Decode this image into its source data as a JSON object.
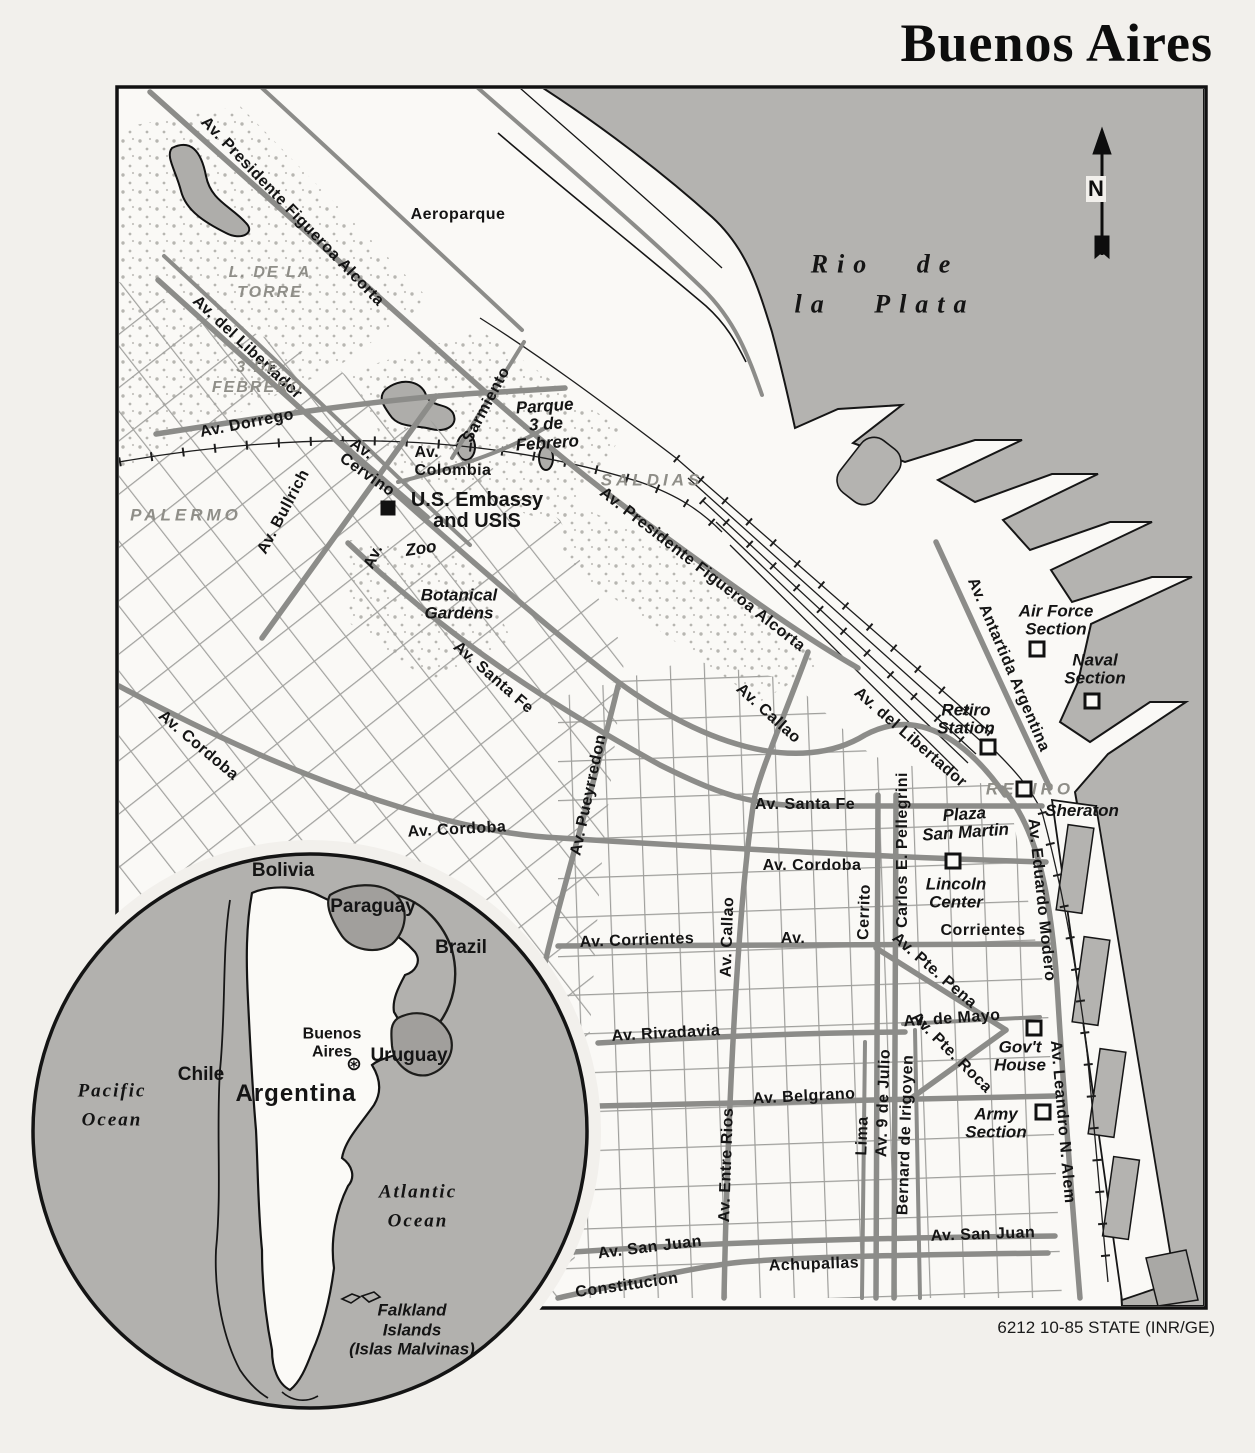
{
  "title": "Buenos Aires",
  "credit": "6212 10-85 STATE (INR/GE)",
  "north_label": "N",
  "colors": {
    "paper": "#f2f0ec",
    "land": "#faf9f6",
    "river": "#b4b3b0",
    "road": "#8c8c89",
    "grid": "#9f9f9c",
    "lake": "#aeadaa",
    "gray_text": "#8f8e88",
    "ink": "#141414"
  },
  "labels": [
    {
      "name": "av-presidente-figueroa-alcorta-1",
      "text": "Av. Presidente Figueroa Alcorta",
      "cls": "road",
      "x": 292,
      "y": 212,
      "rot": 46
    },
    {
      "name": "aeroparque",
      "text": "Aeroparque",
      "cls": "road",
      "x": 458,
      "y": 215,
      "rot": 0
    },
    {
      "name": "rio-de-la-plata",
      "text": "Rio de\nla Plata",
      "cls": "water",
      "x": 885,
      "y": 285,
      "rot": 0
    },
    {
      "name": "l-de-la-torre",
      "text": "L. DE LA\nTORRE",
      "cls": "gray-sm",
      "x": 270,
      "y": 283,
      "rot": 0
    },
    {
      "name": "av-del-libertador-1",
      "text": "Av. del Libertador",
      "cls": "road",
      "x": 247,
      "y": 348,
      "rot": 43
    },
    {
      "name": "3-de-febrero",
      "text": "3 DE\nFEBRERO",
      "cls": "gray-sm",
      "x": 258,
      "y": 378,
      "rot": 0
    },
    {
      "name": "av-dorrego",
      "text": "Av. Dorrego",
      "cls": "road",
      "x": 247,
      "y": 424,
      "rot": -11
    },
    {
      "name": "sarmiento",
      "text": "Sarmiento",
      "cls": "road",
      "x": 487,
      "y": 405,
      "rot": -62
    },
    {
      "name": "parque-3-de-febrero",
      "text": "Parque\n3 de\nFebrero",
      "cls": "place",
      "x": 546,
      "y": 425,
      "rot": -4
    },
    {
      "name": "av-cervino",
      "text": "Av.\nCervino",
      "cls": "road",
      "x": 372,
      "y": 468,
      "rot": 35
    },
    {
      "name": "av-colombia",
      "text": "Av.\nColombia",
      "cls": "road",
      "x": 453,
      "y": 462,
      "rot": 0
    },
    {
      "name": "saldias",
      "text": "SALDIAS",
      "cls": "gray",
      "x": 652,
      "y": 480,
      "rot": 0
    },
    {
      "name": "palermo",
      "text": "PALERMO",
      "cls": "gray",
      "x": 186,
      "y": 515,
      "rot": 0
    },
    {
      "name": "av-bullrich",
      "text": "Av. Bullrich",
      "cls": "road",
      "x": 284,
      "y": 512,
      "rot": -62
    },
    {
      "name": "us-embassy",
      "text": "U.S. Embassy\nand USIS",
      "cls": "embassy",
      "x": 477,
      "y": 511,
      "rot": 0
    },
    {
      "name": "zoo",
      "text": "Zoo",
      "cls": "place",
      "x": 421,
      "y": 549,
      "rot": -8
    },
    {
      "name": "av-las-heras",
      "text": "Av.",
      "cls": "road",
      "x": 374,
      "y": 557,
      "rot": -65
    },
    {
      "name": "av-presidente-figueroa-alcorta-2",
      "text": "Av. Presidente Figueroa Alcorta",
      "cls": "road",
      "x": 702,
      "y": 570,
      "rot": 38
    },
    {
      "name": "botanical-gardens",
      "text": "Botanical\nGardens",
      "cls": "place",
      "x": 459,
      "y": 605,
      "rot": 0
    },
    {
      "name": "air-force-section",
      "text": "Air Force\nSection",
      "cls": "place",
      "x": 1056,
      "y": 621,
      "rot": 0
    },
    {
      "name": "naval-section",
      "text": "Naval\nSection",
      "cls": "place",
      "x": 1095,
      "y": 670,
      "rot": 0
    },
    {
      "name": "av-antartida-argentina",
      "text": "Av. Antartida Argentina",
      "cls": "road",
      "x": 1008,
      "y": 665,
      "rot": 67
    },
    {
      "name": "av-santa-fe-diagonal",
      "text": "Av. Santa Fe",
      "cls": "road",
      "x": 493,
      "y": 678,
      "rot": 41
    },
    {
      "name": "av-cordoba-diagonal",
      "text": "Av. Cordoba",
      "cls": "road",
      "x": 198,
      "y": 746,
      "rot": 40
    },
    {
      "name": "av-callao-diagonal",
      "text": "Av. Callao",
      "cls": "road",
      "x": 768,
      "y": 714,
      "rot": 42
    },
    {
      "name": "retiro-station",
      "text": "Retiro\nStation",
      "cls": "place",
      "x": 966,
      "y": 720,
      "rot": 0
    },
    {
      "name": "av-del-libertador-2",
      "text": "Av. del Libertador",
      "cls": "road",
      "x": 910,
      "y": 738,
      "rot": 41
    },
    {
      "name": "av-pueyrredon",
      "text": "Av. Pueyrredon",
      "cls": "road",
      "x": 589,
      "y": 795,
      "rot": -78
    },
    {
      "name": "retiro",
      "text": "RETIRO",
      "cls": "gray",
      "x": 1030,
      "y": 789,
      "rot": 0
    },
    {
      "name": "sheraton",
      "text": "Sheraton",
      "cls": "place",
      "x": 1082,
      "y": 811,
      "rot": 0
    },
    {
      "name": "av-santa-fe-horizontal",
      "text": "Av. Santa Fe",
      "cls": "road",
      "x": 805,
      "y": 805,
      "rot": 0
    },
    {
      "name": "plaza-san-martin",
      "text": "Plaza\nSan Martin",
      "cls": "place",
      "x": 965,
      "y": 824,
      "rot": -4
    },
    {
      "name": "av-cordoba-horizontal-1",
      "text": "Av. Cordoba",
      "cls": "road",
      "x": 457,
      "y": 830,
      "rot": -3
    },
    {
      "name": "carlos-e-pellegrini",
      "text": "Carlos E. Pellegrini",
      "cls": "road",
      "x": 903,
      "y": 850,
      "rot": -90
    },
    {
      "name": "av-cordoba-horizontal-2",
      "text": "Av. Cordoba",
      "cls": "road",
      "x": 812,
      "y": 866,
      "rot": 0
    },
    {
      "name": "lincoln-center",
      "text": "Lincoln\nCenter",
      "cls": "place",
      "x": 956,
      "y": 894,
      "rot": 0
    },
    {
      "name": "av-eduardo-modero",
      "text": "Av. Eduardo Modero",
      "cls": "road",
      "x": 1041,
      "y": 900,
      "rot": 84
    },
    {
      "name": "cerrito",
      "text": "Cerrito",
      "cls": "road",
      "x": 865,
      "y": 912,
      "rot": -88
    },
    {
      "name": "corrientes-label-av",
      "text": "Av.",
      "cls": "road",
      "x": 793,
      "y": 939,
      "rot": 0
    },
    {
      "name": "corrientes-label",
      "text": "Corrientes",
      "cls": "road",
      "x": 983,
      "y": 931,
      "rot": 0
    },
    {
      "name": "av-callao-vertical",
      "text": "Av. Callao",
      "cls": "road",
      "x": 728,
      "y": 937,
      "rot": -88
    },
    {
      "name": "av-corrientes",
      "text": "Av. Corrientes",
      "cls": "road",
      "x": 637,
      "y": 941,
      "rot": -2
    },
    {
      "name": "av-pte-pena",
      "text": "Av. Pte. Pena",
      "cls": "road",
      "x": 934,
      "y": 971,
      "rot": 41
    },
    {
      "name": "av-de-mayo",
      "text": "Av. de Mayo",
      "cls": "road",
      "x": 952,
      "y": 1019,
      "rot": -4
    },
    {
      "name": "av-rivadavia",
      "text": "Av. Rivadavia",
      "cls": "road",
      "x": 666,
      "y": 1034,
      "rot": -3
    },
    {
      "name": "av-pte-roca",
      "text": "Av. Pte. Roca",
      "cls": "road",
      "x": 951,
      "y": 1053,
      "rot": 45
    },
    {
      "name": "govt-house",
      "text": "Gov't\nHouse",
      "cls": "place",
      "x": 1020,
      "y": 1057,
      "rot": 0
    },
    {
      "name": "av-belgrano",
      "text": "Av. Belgrano",
      "cls": "road",
      "x": 804,
      "y": 1097,
      "rot": -3
    },
    {
      "name": "av-9-de-julio",
      "text": "Av. 9 de Julio",
      "cls": "road",
      "x": 884,
      "y": 1103,
      "rot": -88
    },
    {
      "name": "army-section",
      "text": "Army\nSection",
      "cls": "place",
      "x": 996,
      "y": 1124,
      "rot": 0
    },
    {
      "name": "av-leandro-n-alem",
      "text": "Av. Leandro N. Alem",
      "cls": "road",
      "x": 1062,
      "y": 1122,
      "rot": 85
    },
    {
      "name": "lima",
      "text": "Lima",
      "cls": "road",
      "x": 863,
      "y": 1136,
      "rot": -88
    },
    {
      "name": "bernard-de-irigoyen",
      "text": "Bernard de Irigoyen",
      "cls": "road",
      "x": 906,
      "y": 1135,
      "rot": -88
    },
    {
      "name": "av-entre-rios",
      "text": "Av. Entre Rios",
      "cls": "road",
      "x": 727,
      "y": 1165,
      "rot": -88
    },
    {
      "name": "av-san-juan-west",
      "text": "Av. San Juan",
      "cls": "road",
      "x": 650,
      "y": 1248,
      "rot": -7
    },
    {
      "name": "av-san-juan-east",
      "text": "Av. San Juan",
      "cls": "road",
      "x": 983,
      "y": 1235,
      "rot": -2
    },
    {
      "name": "achupallas",
      "text": "Achupallas",
      "cls": "road",
      "x": 814,
      "y": 1265,
      "rot": -2
    },
    {
      "name": "constitucion",
      "text": "Constitucion",
      "cls": "road",
      "x": 627,
      "y": 1286,
      "rot": -8
    },
    {
      "name": "bolivia",
      "text": "Bolivia",
      "cls": "country",
      "x": 283,
      "y": 871,
      "rot": 0
    },
    {
      "name": "paraguay",
      "text": "Paraguay",
      "cls": "country",
      "x": 373,
      "y": 907,
      "rot": 0
    },
    {
      "name": "brazil",
      "text": "Brazil",
      "cls": "country",
      "x": 461,
      "y": 948,
      "rot": 0
    },
    {
      "name": "buenos-aires-city",
      "text": "Buenos\nAires",
      "cls": "city",
      "x": 332,
      "y": 1043,
      "rot": 0
    },
    {
      "name": "uruguay",
      "text": "Uruguay",
      "cls": "country",
      "x": 409,
      "y": 1056,
      "rot": 0
    },
    {
      "name": "chile",
      "text": "Chile",
      "cls": "country",
      "x": 201,
      "y": 1075,
      "rot": 0
    },
    {
      "name": "argentina",
      "text": "Argentina",
      "cls": "country-lg",
      "x": 296,
      "y": 1094,
      "rot": 0
    },
    {
      "name": "pacific-ocean",
      "text": "Pacific\nOcean",
      "cls": "ocean",
      "x": 112,
      "y": 1106,
      "rot": 0
    },
    {
      "name": "atlantic-ocean",
      "text": "Atlantic\nOcean",
      "cls": "ocean",
      "x": 418,
      "y": 1207,
      "rot": 0
    },
    {
      "name": "falkland-islands",
      "text": "Falkland\nIslands\n(Islas Malvinas)",
      "cls": "falk",
      "x": 412,
      "y": 1330,
      "rot": 0
    }
  ],
  "markers": [
    {
      "name": "us-embassy-marker",
      "type": "sqf",
      "x": 388,
      "y": 508
    },
    {
      "name": "air-force-section-marker",
      "type": "sq",
      "x": 1037,
      "y": 649
    },
    {
      "name": "naval-section-marker",
      "type": "sq",
      "x": 1092,
      "y": 701
    },
    {
      "name": "retiro-station-marker",
      "type": "sq",
      "x": 988,
      "y": 747
    },
    {
      "name": "sheraton-marker",
      "type": "sq",
      "x": 1024,
      "y": 789
    },
    {
      "name": "lincoln-center-marker",
      "type": "sq",
      "x": 953,
      "y": 861
    },
    {
      "name": "govt-house-marker",
      "type": "sq",
      "x": 1034,
      "y": 1028
    },
    {
      "name": "army-section-marker",
      "type": "sq",
      "x": 1043,
      "y": 1112
    },
    {
      "name": "buenos-aires-star",
      "type": "star",
      "glyph": "⊛",
      "x": 354,
      "y": 1064
    }
  ]
}
